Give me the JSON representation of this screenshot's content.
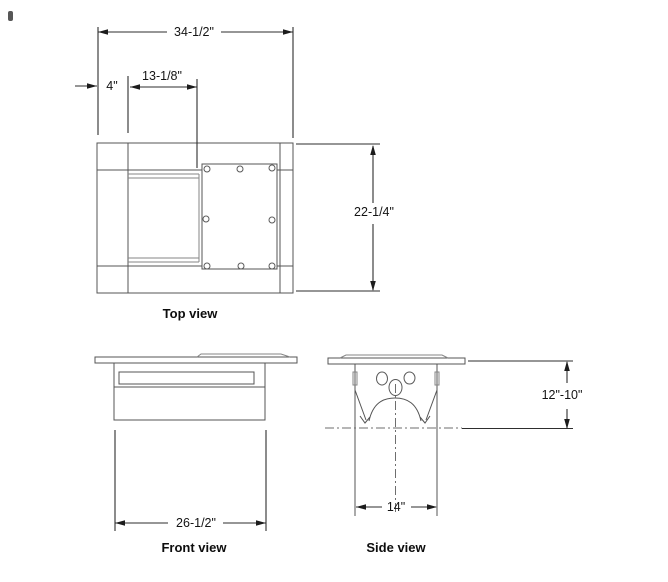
{
  "meta": {
    "background_color": "#ffffff",
    "line_color": "#545454",
    "dimension_color": "#2e2e2e",
    "text_color": "#141414"
  },
  "views": {
    "top": {
      "label": "Top view",
      "dim_overall_width": "34-1/2\"",
      "dim_left_offset": "4\"",
      "dim_inner_width": "13-1/8\"",
      "dim_depth": "22-1/4\""
    },
    "front": {
      "label": "Front view",
      "dim_width": "26-1/2\""
    },
    "side": {
      "label": "Side view",
      "dim_height": "12\"-10\"",
      "dim_width": "14\""
    }
  }
}
